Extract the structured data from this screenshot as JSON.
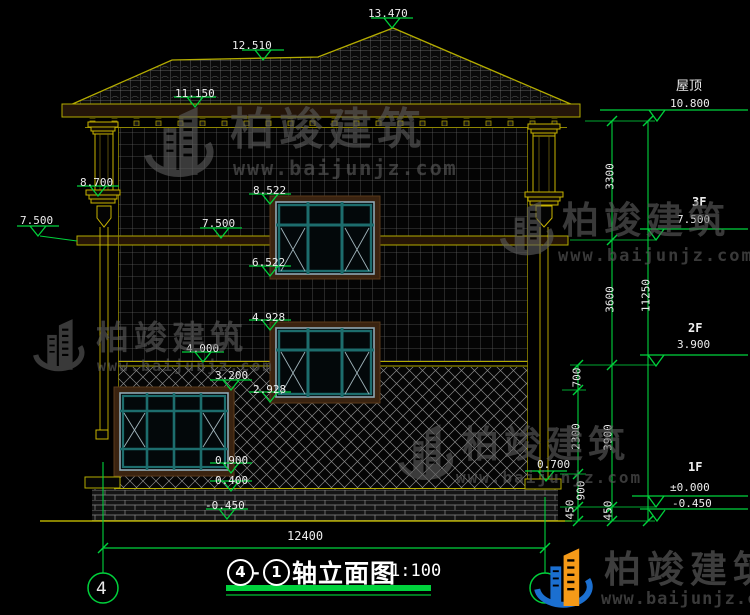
{
  "watermark": {
    "brand": "柏竣建筑",
    "url": "www.baijunjz.com"
  },
  "title": {
    "axis_left": "4",
    "dash": "-",
    "axis_right": "1",
    "text": "轴立面图",
    "scale": "1:100"
  },
  "axis_bubble_left": "4",
  "top_levels": {
    "peak": "13.470",
    "ridge": "12.510",
    "eave": "11.150"
  },
  "left_levels": {
    "l8700": "8.700",
    "l7500_out": "7.500",
    "l8522": "8.522",
    "l7500_mid": "7.500",
    "l6522": "6.522",
    "l4928": "4.928",
    "l4000": "4.000",
    "l3200": "3.200",
    "l2928": "2.928",
    "l0900": "0.900",
    "l0400": "0.400",
    "l0700": "0.700",
    "lm0450": "-0.450"
  },
  "right_levels": {
    "roof_name": "屋顶",
    "roof": "10.800",
    "f3_name": "3F",
    "f3": "7.500",
    "f2_name": "2F",
    "f2": "3.900",
    "f1_name": "1F",
    "f1": "±0.000",
    "ground": "-0.450"
  },
  "dims": {
    "inner": [
      "700",
      "2300",
      "900",
      "450"
    ],
    "story": [
      "3300",
      "3600",
      "3900",
      "450"
    ],
    "overall": "11250",
    "width": "12400"
  },
  "colors": {
    "background": "#000000",
    "cad_green": "#00d23c",
    "cad_yellow": "#b4ac00",
    "column_yellow": "#c8b400",
    "window_teal": "#1d6d6d",
    "window_steel": "#8fa8b5",
    "band_brown": "#3a2310",
    "watermark_gray": "#5c5c5c",
    "logo_blue": "#1b6fd0",
    "logo_orange": "#f59a18",
    "text_white": "#ededed"
  }
}
